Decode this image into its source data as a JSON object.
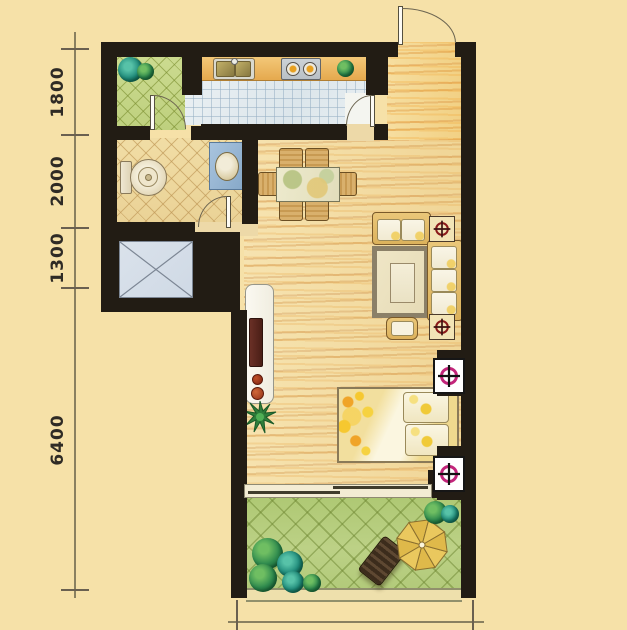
{
  "dimensions": {
    "left": [
      {
        "label": "1800"
      },
      {
        "label": "2000"
      },
      {
        "label": "1300"
      },
      {
        "label": "6400"
      }
    ]
  },
  "colors": {
    "background": "#F6E1A8",
    "wall": "#221C14",
    "wood_floor": "#F2D99E",
    "wood_grain": "#C9863B",
    "kitchen_tile": "#E3EBEF",
    "bath_tile": "#EFD9A0",
    "service_balcony_tile": "#C9D98B",
    "garden_balcony_tile": "#B5CC7C",
    "shaft_fill": "#D5DEE8",
    "ac_marker_magenta": "#C2257A",
    "ac_marker_red": "#8B1A1A",
    "umbrella": "#E6C158"
  }
}
